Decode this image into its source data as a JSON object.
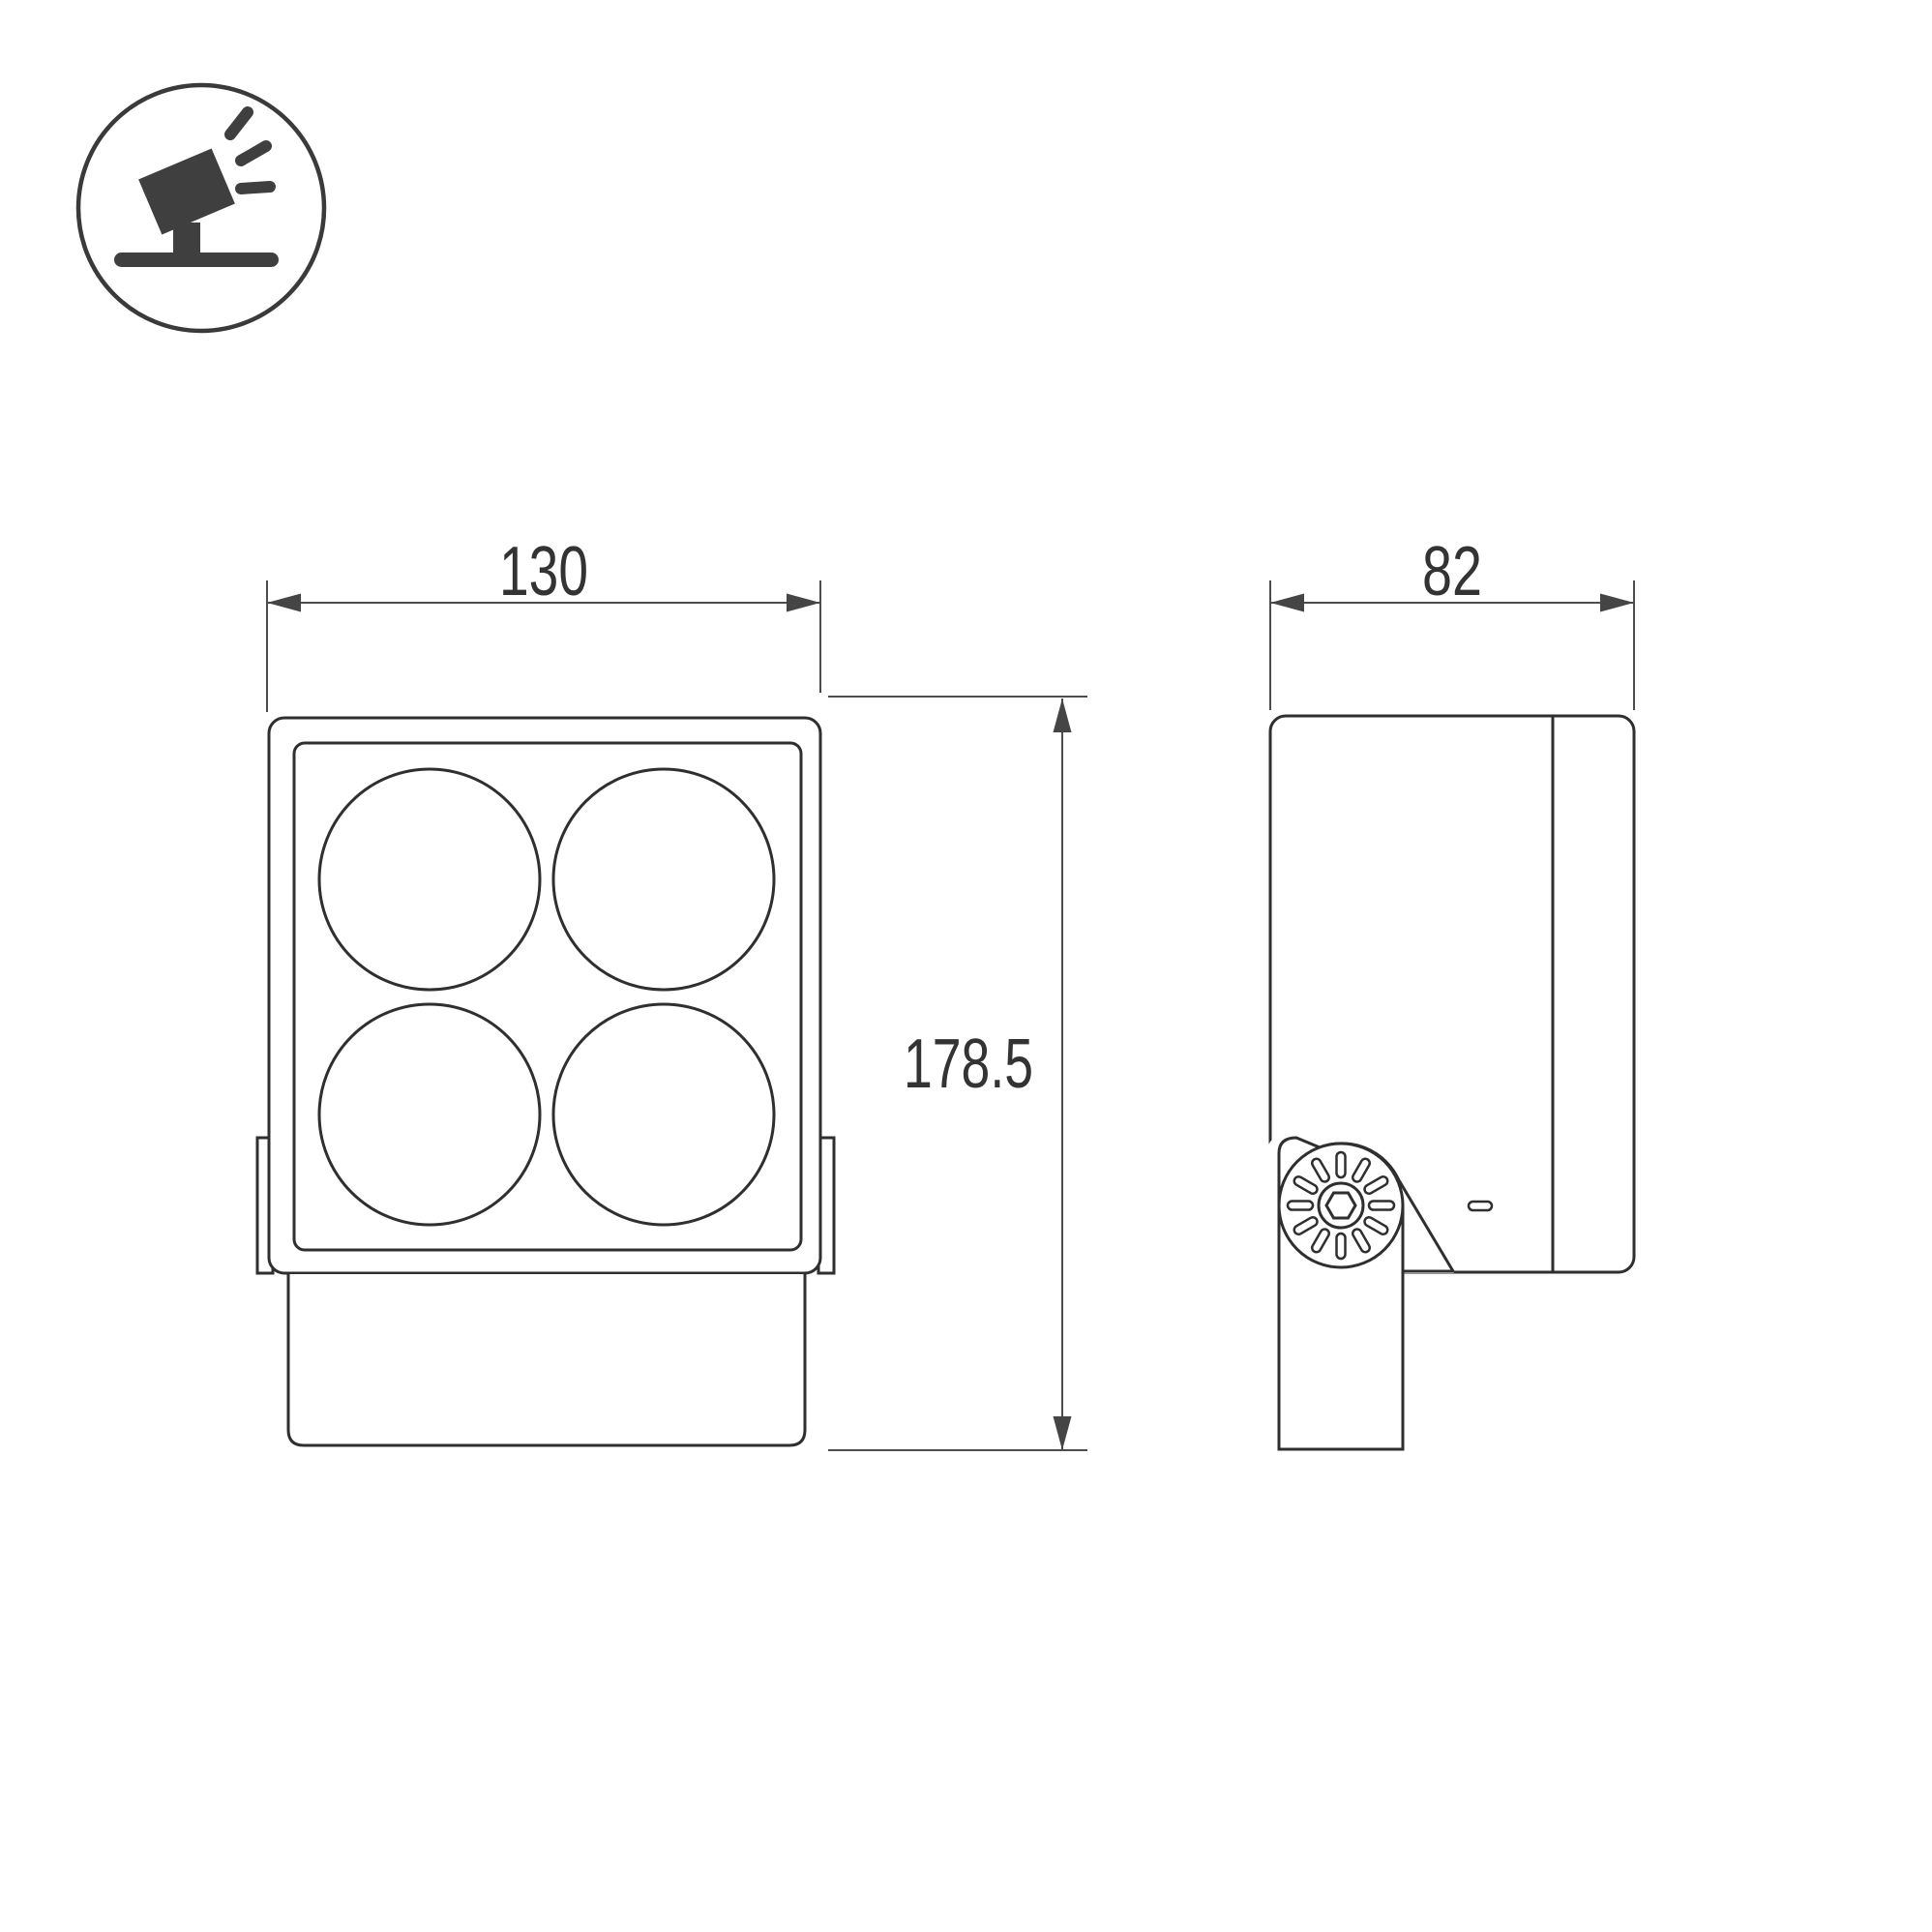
{
  "meta": {
    "background_color": "#ffffff",
    "line_color": "#2f2f2f",
    "dim_line_color": "#4d4d4d",
    "icon_fill_color": "#3f3f3f",
    "text_color": "#333333"
  },
  "icon": {
    "name": "tilted-floodlight-on-stand"
  },
  "views": {
    "front": {
      "description_name": "front-view-four-lens-floodlight",
      "lens_count": 4
    },
    "side": {
      "description_name": "side-view-with-mounting-bracket"
    }
  },
  "dimensions": {
    "front_width": "130",
    "front_height": "178.5",
    "side_depth": "82"
  }
}
